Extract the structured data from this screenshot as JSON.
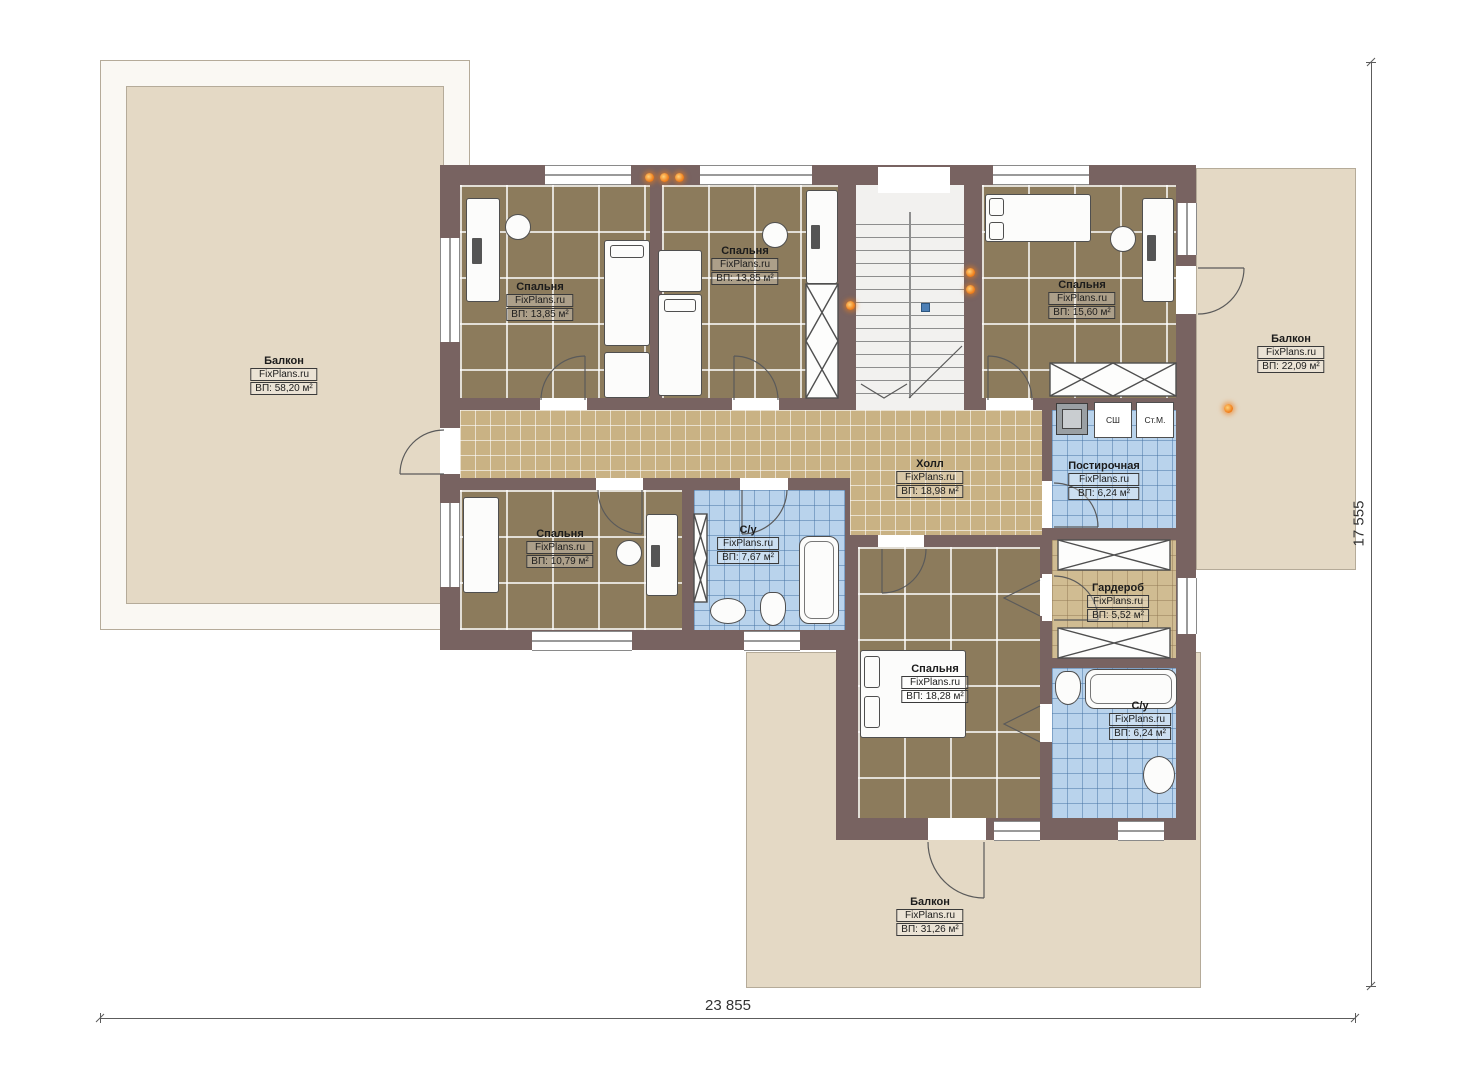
{
  "brand": "FixPlans.ru",
  "rooms": {
    "balcony_left": {
      "name": "Балкон",
      "brand": "FixPlans.ru",
      "area": "ВП: 58,20 м²"
    },
    "bedroom_top_left": {
      "name": "Спальня",
      "brand": "FixPlans.ru",
      "area": "ВП: 13,85 м²"
    },
    "bedroom_top_center": {
      "name": "Спальня",
      "brand": "FixPlans.ru",
      "area": "ВП: 13,85 м²"
    },
    "bedroom_top_right": {
      "name": "Спальня",
      "brand": "FixPlans.ru",
      "area": "ВП: 15,60 м²"
    },
    "balcony_right": {
      "name": "Балкон",
      "brand": "FixPlans.ru",
      "area": "ВП: 22,09 м²"
    },
    "hall": {
      "name": "Холл",
      "brand": "FixPlans.ru",
      "area": "ВП: 18,98 м²"
    },
    "laundry": {
      "name": "Постирочная",
      "brand": "FixPlans.ru",
      "area": "ВП: 6,24 м²"
    },
    "bedroom_bottom_left": {
      "name": "Спальня",
      "brand": "FixPlans.ru",
      "area": "ВП: 10,79 м²"
    },
    "bathroom_center": {
      "name": "С/у",
      "brand": "FixPlans.ru",
      "area": "ВП: 7,67 м²"
    },
    "wardrobe": {
      "name": "Гардероб",
      "brand": "FixPlans.ru",
      "area": "ВП: 5,52 м²"
    },
    "bedroom_bottom": {
      "name": "Спальня",
      "brand": "FixPlans.ru",
      "area": "ВП: 18,28 м²"
    },
    "bathroom_bottom_right": {
      "name": "С/у",
      "brand": "FixPlans.ru",
      "area": "ВП: 6,24 м²"
    },
    "balcony_bottom": {
      "name": "Балкон",
      "brand": "FixPlans.ru",
      "area": "ВП: 31,26 м²"
    }
  },
  "appliances": {
    "drying_cabinet": "СШ",
    "washing_machine": "Ст.М."
  },
  "dimensions": {
    "total_width": "23 855",
    "total_height": "17 555"
  },
  "colors": {
    "wall": "#786361",
    "carpet": "#8c7b5c",
    "hall_tile": "#c9b284",
    "bath_tile": "#b9d3ec",
    "balcony": "#e4d9c5",
    "light_accent": "#ef7d1a"
  }
}
